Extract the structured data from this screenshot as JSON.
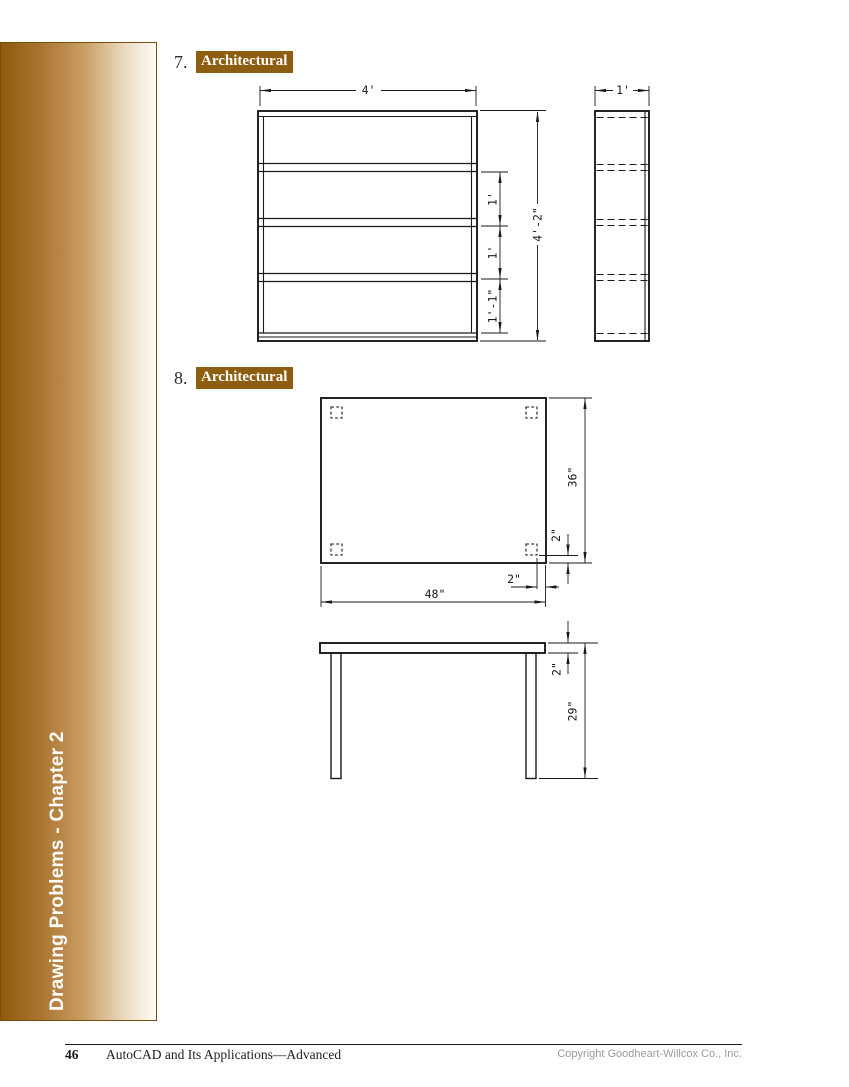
{
  "sidebar": {
    "label": "Drawing Problems - Chapter 2"
  },
  "problems": [
    {
      "number": "7.",
      "category": "Architectural",
      "drawing": {
        "type": "bookshelf-front-and-side-views",
        "dims": {
          "front_width": "4'",
          "side_width": "1'",
          "overall_height": "4'-2\"",
          "shelf_space_upper": "1'",
          "shelf_space_middle": "1'",
          "shelf_space_lower": "1'-1\""
        }
      }
    },
    {
      "number": "8.",
      "category": "Architectural",
      "drawing": {
        "type": "table-top-and-front-views",
        "dims": {
          "top_depth": "36\"",
          "leg_inset_bottom": "2\"",
          "leg_inset_right": "2\"",
          "top_width": "48\"",
          "top_thickness": "2\"",
          "overall_height": "29\""
        }
      }
    }
  ],
  "footer": {
    "page_number": "46",
    "book_title": "AutoCAD and Its Applications—Advanced",
    "copyright": "Copyright Goodheart-Willcox Co., Inc."
  },
  "colors": {
    "accent_brown": "#8D5E10",
    "line_color": "#1A1A1A"
  }
}
